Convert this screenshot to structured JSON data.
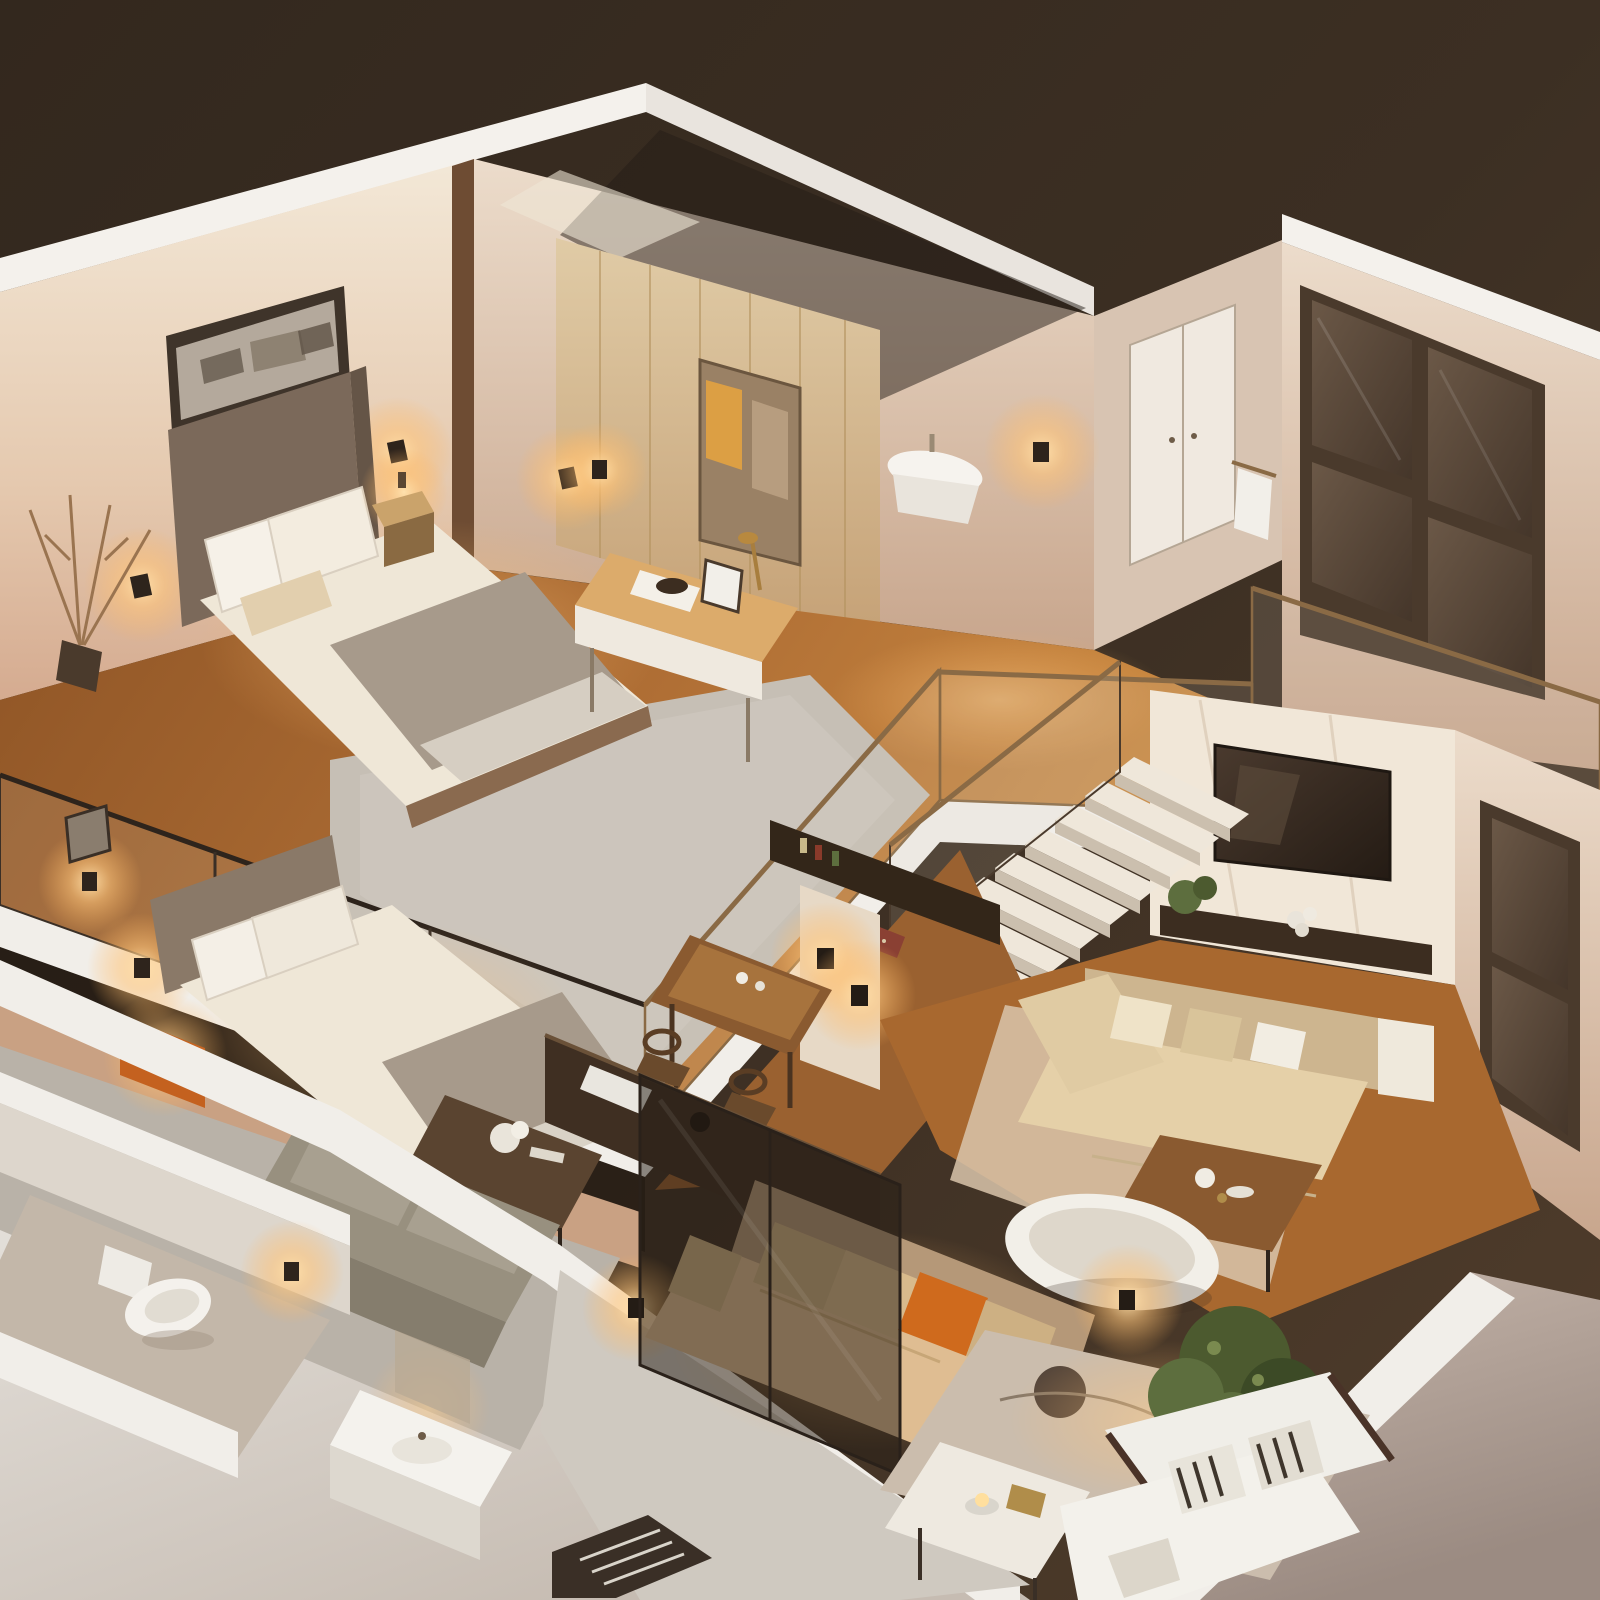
{
  "title": "Isometric cutaway 3D render of a two-story loft apartment at night",
  "style": {
    "view": "isometric dollhouse cutaway from above",
    "lighting": "warm amber interior night lighting",
    "media": "photorealistic 3D architectural render, no text or UI elements"
  },
  "palette": {
    "bg_top": "#342a20",
    "bg_right": "#4d3b2a",
    "ground_light": "#e9e6e1",
    "ground_taupe": "#a3948b",
    "wall_white": "#f4f1ec",
    "wall_cream": "#ecdfc9",
    "wall_blush": "#d9b49c",
    "wall_shadow": "#d8c4b2",
    "wood_wall": "#d4bb94",
    "wood_pillar": "#6e4c33",
    "wood_floor": "#a8682f",
    "wood_floor_lit": "#c8873f",
    "shag_rug": "#c6bfb5",
    "carpet_grey": "#b9b2a8",
    "headboard": "#7b695a",
    "bedding_white": "#efe7d7",
    "throw_taupe": "#a79a8b",
    "sofa_cream_seat": "#e5d0a8",
    "sofa_cream_back": "#cdb58f",
    "sofa_beige_seat": "#dfbd92",
    "sofa_beige_back": "#b59878",
    "sofa_white": "#f0eee8",
    "sofa_grey": "#98907f",
    "pillow_orange": "#cf6a1d",
    "niche_orange": "#c4611f",
    "amber_glow": "#ffc97c",
    "lamp_core": "#ffe9c2",
    "tv_screen": "#322820",
    "console_dark": "#3c2d20",
    "counter_dark": "#3f2f22",
    "glass_tint": "rgba(35,27,20,0.5)",
    "glass_clear": "rgba(215,205,190,0.14)",
    "frame_bronze": "#8a6a45",
    "frame_dark": "#4a3a2c",
    "window_pane": "#5e4d3e",
    "door_white": "#f0e9e0",
    "plant_green": "#4c5a2f",
    "plant_green_light": "#5d6e3e",
    "porcelain": "#f4f1ec",
    "table_wood": "#8a5a30",
    "rug_beige": "#cbbdad",
    "rug_spot": "#54453a",
    "stair_tread": "#efe7da",
    "stair_riser": "#cbbfae",
    "slab_white": "#f1eee9",
    "under_shadow": "rgba(20,14,9,0.45)",
    "art_frame": "#3f342a",
    "art_paper": "#b4a99c"
  },
  "scene": {
    "upper_floor": {
      "rooms": [
        {
          "name": "master-bedroom",
          "furniture": [
            "double-bed",
            "upholstered-headboard",
            "white-pillows",
            "grey-throw-blanket",
            "shag-rug",
            "nightstand-lamp",
            "panoramic-wall-art",
            "wall-sconces",
            "dried-branch-plant",
            "glass-balustrade"
          ]
        },
        {
          "name": "vanity-nook",
          "furniture": [
            "wood-panel-accent-wall",
            "vanity-desk",
            "mirror",
            "brass-desk-lamp",
            "photo-frame",
            "wall-sconce"
          ]
        },
        {
          "name": "upper-bathroom",
          "furniture": [
            "wall-hung-sink",
            "wall-sconce",
            "towel-rail"
          ]
        },
        {
          "name": "hallway",
          "furniture": [
            "white-double-door",
            "dark-gridded-window"
          ]
        },
        {
          "name": "landing",
          "furniture": [
            "bronze-framed-glass-railing",
            "bridge-walkway",
            "staircase"
          ]
        }
      ]
    },
    "lower_floor": {
      "rooms": [
        {
          "name": "kitchen-dining",
          "furniture": [
            "bar-table",
            "wooden-stools",
            "dark-shelf",
            "sconce-pillar"
          ]
        },
        {
          "name": "living-room",
          "furniture": [
            "tv-wall",
            "flat-screen-tv",
            "media-console",
            "console-plants",
            "cream-sectional-sofa",
            "wood-coffee-table",
            "freestanding-bathtub",
            "tall-dark-window"
          ]
        },
        {
          "name": "guest-bedroom",
          "furniture": [
            "double-bed",
            "orange-lit-nightstand",
            "wall-sconces",
            "grey-loveseat",
            "flower-coffee-table"
          ]
        },
        {
          "name": "bathroom",
          "furniture": [
            "wall-hung-toilet",
            "vanity-sink",
            "wall-sconce"
          ]
        },
        {
          "name": "media-lounge",
          "furniture": [
            "beige-sofa",
            "orange-accent-pillow",
            "patterned-rug",
            "white-coffee-table",
            "candle",
            "dark-glass-partition",
            "kitchen-island"
          ]
        },
        {
          "name": "front-corner",
          "furniture": [
            "potted-plant",
            "white-sofa",
            "zebra-striped-pillows",
            "wall-sconce",
            "slatted-chair"
          ]
        }
      ]
    }
  }
}
